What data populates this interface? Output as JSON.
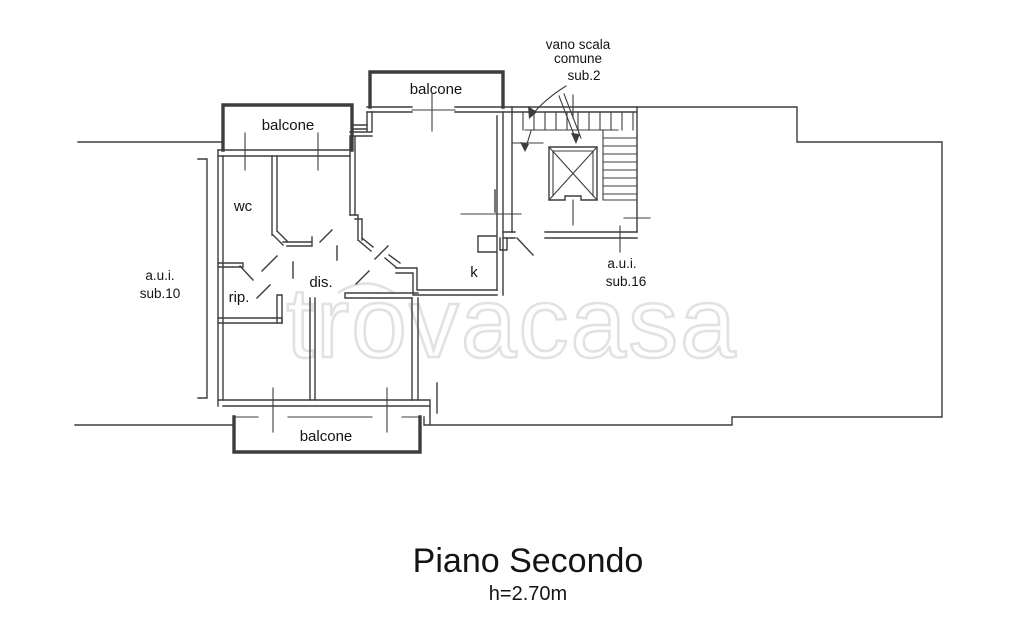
{
  "plan": {
    "balcony_top_left": "balcone",
    "balcony_top_middle": "balcone",
    "balcony_bottom": "balcone",
    "room_wc": "wc",
    "room_rip": "rip.",
    "room_dis": "dis.",
    "room_k": "k",
    "unit_sub10": {
      "l1": "a.u.i.",
      "l2": "sub.10"
    },
    "unit_sub16": {
      "l1": "a.u.i.",
      "l2": "sub.16"
    },
    "stair_label": {
      "l1": "vano scala",
      "l2": "comune",
      "l3": "sub.2"
    }
  },
  "watermark": "trovacasa",
  "title": {
    "main": "Piano Secondo",
    "subtitle": "h=2.70m"
  },
  "colors": {
    "line": "#3d3d3d",
    "text": "#141414",
    "watermark": "#e2e2e2",
    "background": "#ffffff"
  }
}
